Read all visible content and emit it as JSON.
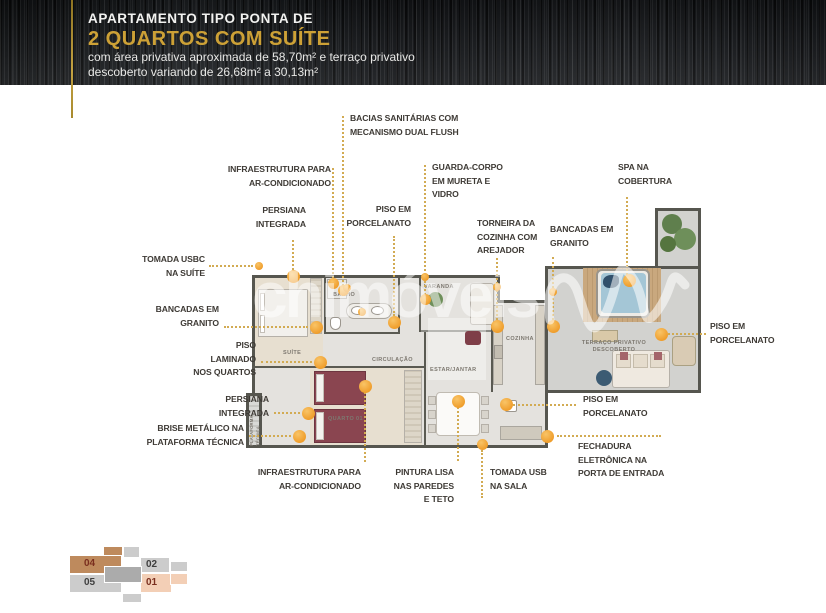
{
  "header": {
    "line1": "APARTAMENTO TIPO PONTA DE",
    "line2": "2 QUARTOS COM SUÍTE",
    "line3": "com área privativa aproximada de 58,70m² e terraço privativo\ndescoberto variando de 26,68m² a 30,13m²"
  },
  "callouts": {
    "bacias": "BACIAS SANITÁRIAS COM\nMECANISMO DUAL FLUSH",
    "infra_ac_top": "INFRAESTRUTURA PARA\nAR-CONDICIONADO",
    "persiana_top": "PERSIANA\nINTEGRADA",
    "piso_porcelanato_top": "PISO EM\nPORCELANATO",
    "guarda_corpo": "GUARDA-CORPO\nEM MURETA E\nVIDRO",
    "torneira": "TORNEIRA DA\nCOZINHA COM\nAREJADOR",
    "bancadas_right": "BANCADAS EM\nGRANITO",
    "spa": "SPA NA\nCOBERTURA",
    "tomada_usbc": "TOMADA USBC\nNA SUÍTE",
    "bancadas_left": "BANCADAS EM\nGRANITO",
    "piso_laminado": "PISO\nLAMINADO\nNOS QUARTOS",
    "persiana_left": "PERSIANA\nINTEGRADA",
    "brise": "BRISE METÁLICO NA\nPLATAFORMA TÉCNICA",
    "infra_ac_bottom": "INFRAESTRUTURA PARA\nAR-CONDICIONADO",
    "pintura": "PINTURA LISA\nNAS PAREDES\nE TETO",
    "tomada_usb": "TOMADA USB\nNA SALA",
    "piso_porcelanato_right": "PISO EM\nPORCELANATO",
    "piso_porcelanato_mid": "PISO EM\nPORCELANATO",
    "fechadura": "FECHADURA\nELETRÔNICA NA\nPORTA DE ENTRADA"
  },
  "rooms": {
    "suite": "SUÍTE",
    "banho": "BANHO",
    "varanda": "VARANDA",
    "circulacao": "CIRCULAÇÃO",
    "estar": "ESTAR/JANTAR",
    "cozinha": "COZINHA",
    "quarto": "QUARTO 01",
    "terraco": "TERRAÇO PRIVATIVO\nDESCOBERTO",
    "plataforma": "PLATAFORMA TÉCNICA"
  },
  "watermark": "chimóveis",
  "keyplan": {
    "unit_top_left": "04",
    "unit_top_right": "02",
    "unit_bottom_left": "05",
    "unit_bottom_right": "01"
  },
  "colors": {
    "accent_gold": "#cda136",
    "callout_dot": "#ef9d2b",
    "callout_line": "#d2ab53",
    "keyplan_highlight_dark": "#be8a5d",
    "keyplan_highlight_light": "#f3cfb6",
    "keyplan_gray": "#cccccc"
  }
}
